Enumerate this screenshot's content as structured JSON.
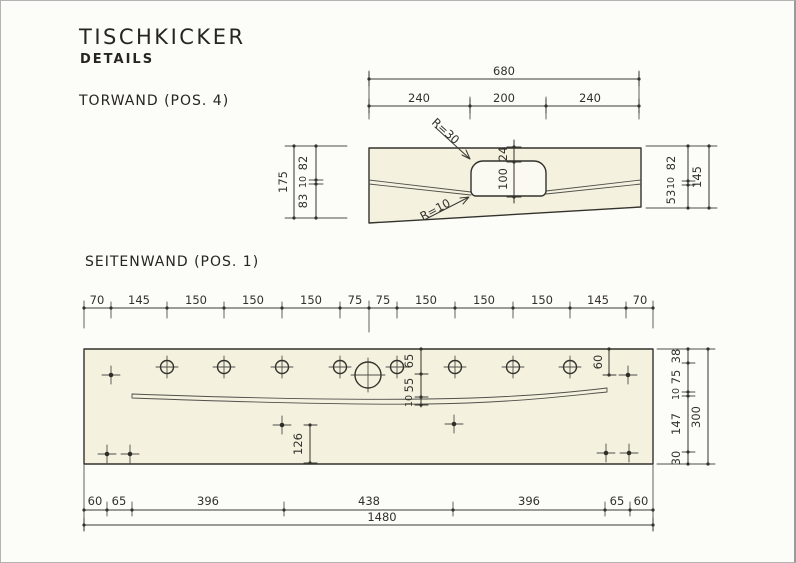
{
  "header": {
    "title": "TISCHKICKER",
    "subtitle": "DETAILS"
  },
  "torwand": {
    "label": "TORWAND (POS. 4)",
    "total_width": "680",
    "width_dims": [
      "240",
      "200",
      "240"
    ],
    "left_total": "175",
    "left_dims": [
      "82",
      "10",
      "83"
    ],
    "right_dims": [
      "82",
      "10",
      "53"
    ],
    "right_total": "145",
    "opening_offset": "24",
    "opening_height": "100",
    "radius_top": "R=30",
    "radius_bottom": "R=10"
  },
  "seitenwand": {
    "label": "SEITENWAND (POS. 1)",
    "top_dims": [
      "70",
      "145",
      "150",
      "150",
      "150",
      "75",
      "75",
      "150",
      "150",
      "150",
      "145",
      "70"
    ],
    "mid_dims": [
      "65",
      "55",
      "10"
    ],
    "hole_offset_top": "60",
    "hole_offset_bottom": "126",
    "right_dims": [
      "38",
      "75",
      "10",
      "147",
      "30"
    ],
    "right_total": "300",
    "bottom_dims": [
      "60",
      "65",
      "396",
      "438",
      "396",
      "65",
      "60"
    ],
    "bottom_total": "1480"
  },
  "colors": {
    "line": "#33322c",
    "panel_fill": "#f4f1df",
    "paper": "#fcfcf8"
  }
}
